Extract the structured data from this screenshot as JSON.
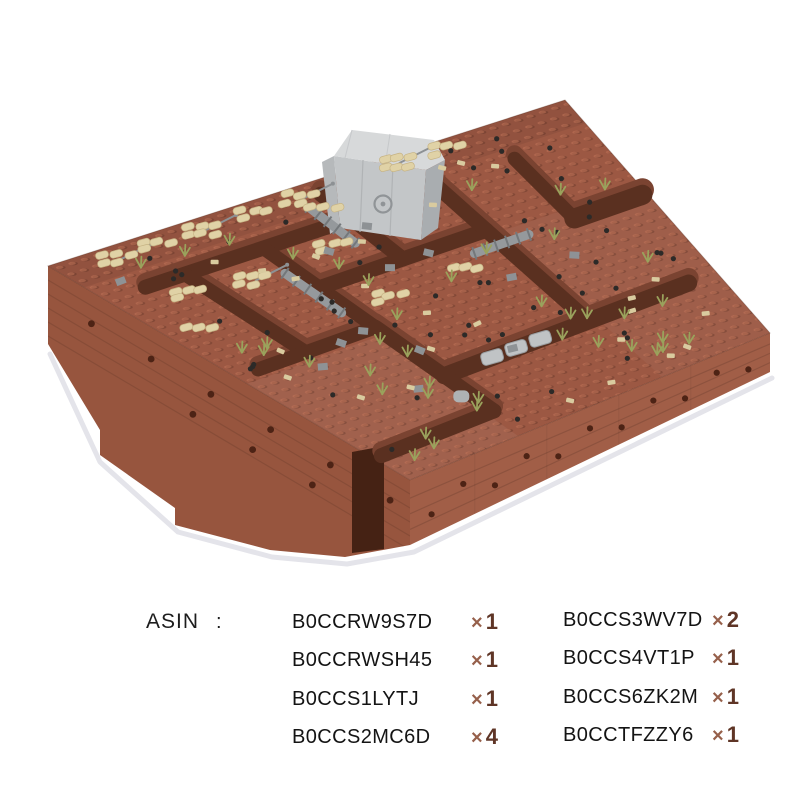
{
  "diorama": {
    "alt": "Isometric LEGO-style brick trench maze diorama: reddish-brown terrain blocks covered in studs, a light gray bunker with a round hatch at top center, tan sandbag emplacements, olive plant tufts, gray rocks and ladders, black round plates, trench corridors with gray stones",
    "colors": {
      "brick_top": "#9c5843",
      "brick_wall_left": "#97553e",
      "brick_wall_right": "#a15e47",
      "brick_shadow": "#7a4331",
      "trench": "#5a3020",
      "tan": "#e0d2a6",
      "olive": "#9aa25c",
      "black_piece": "#2c2a28",
      "gray_piece": "#95999c",
      "bunker_gray": "#c3c6c8"
    }
  },
  "asin": {
    "label": "ASIN",
    "separator": ":",
    "qty_color": "#5f3526",
    "columns": [
      {
        "items": [
          {
            "code": "B0CCRW9S7D",
            "times": "×",
            "count": "1"
          },
          {
            "code": "B0CCRWSH45",
            "times": "×",
            "count": "1"
          },
          {
            "code": "B0CCS1LYTJ",
            "times": "×",
            "count": "1"
          },
          {
            "code": "B0CCS2MC6D",
            "times": "×",
            "count": "4"
          }
        ]
      },
      {
        "items": [
          {
            "code": "B0CCS3WV7D",
            "times": "×",
            "count": "2"
          },
          {
            "code": "B0CCS4VT1P",
            "times": "×",
            "count": "1"
          },
          {
            "code": "B0CCS6ZK2M",
            "times": "×",
            "count": "1"
          },
          {
            "code": "B0CCTFZZY6",
            "times": "×",
            "count": "1"
          }
        ]
      }
    ]
  }
}
